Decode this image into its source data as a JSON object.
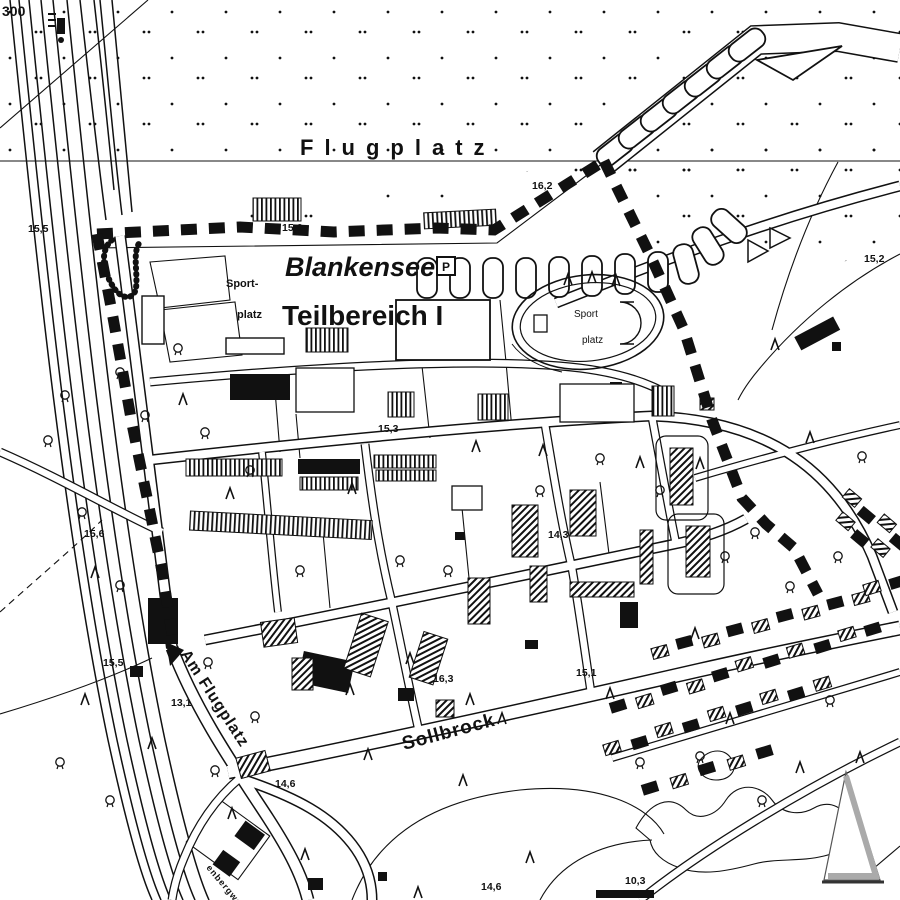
{
  "map": {
    "area_label": "Flugplatz",
    "site_name": "Blankensee",
    "plan_label": "Teilbereich I",
    "sportfield_left": {
      "line1": "Sport-",
      "line2": "platz"
    },
    "sportfield_right": {
      "line1": "Sport",
      "line2": "platz"
    },
    "parking_symbol": "P",
    "corner_coordinate": "300"
  },
  "streets": [
    {
      "name": "Am Flugplatz",
      "x": 180,
      "y": 654,
      "rotation": 57,
      "size": 16
    },
    {
      "name": "Sollbrock",
      "x": 404,
      "y": 750,
      "rotation": -15,
      "size": 19
    },
    {
      "name": "enbergweg",
      "x": 206,
      "y": 868,
      "rotation": 50,
      "size": 9
    }
  ],
  "elevations": [
    {
      "value": "15,5",
      "x": 28,
      "y": 232
    },
    {
      "value": "15,6",
      "x": 282,
      "y": 231
    },
    {
      "value": "16,2",
      "x": 532,
      "y": 189
    },
    {
      "value": "15,2",
      "x": 864,
      "y": 262
    },
    {
      "value": "15,3",
      "x": 378,
      "y": 432
    },
    {
      "value": "15,6",
      "x": 84,
      "y": 537
    },
    {
      "value": "14,3",
      "x": 548,
      "y": 538
    },
    {
      "value": "15,5",
      "x": 103,
      "y": 666
    },
    {
      "value": "13,1",
      "x": 171,
      "y": 706
    },
    {
      "value": "16,3",
      "x": 433,
      "y": 682
    },
    {
      "value": "15,1",
      "x": 576,
      "y": 676
    },
    {
      "value": "14,6",
      "x": 275,
      "y": 787
    },
    {
      "value": "14,6",
      "x": 481,
      "y": 890
    },
    {
      "value": "10,3",
      "x": 625,
      "y": 884
    }
  ],
  "colors": {
    "ink": "#111111",
    "paper": "#ffffff",
    "shadow": "#9a9a9a"
  }
}
